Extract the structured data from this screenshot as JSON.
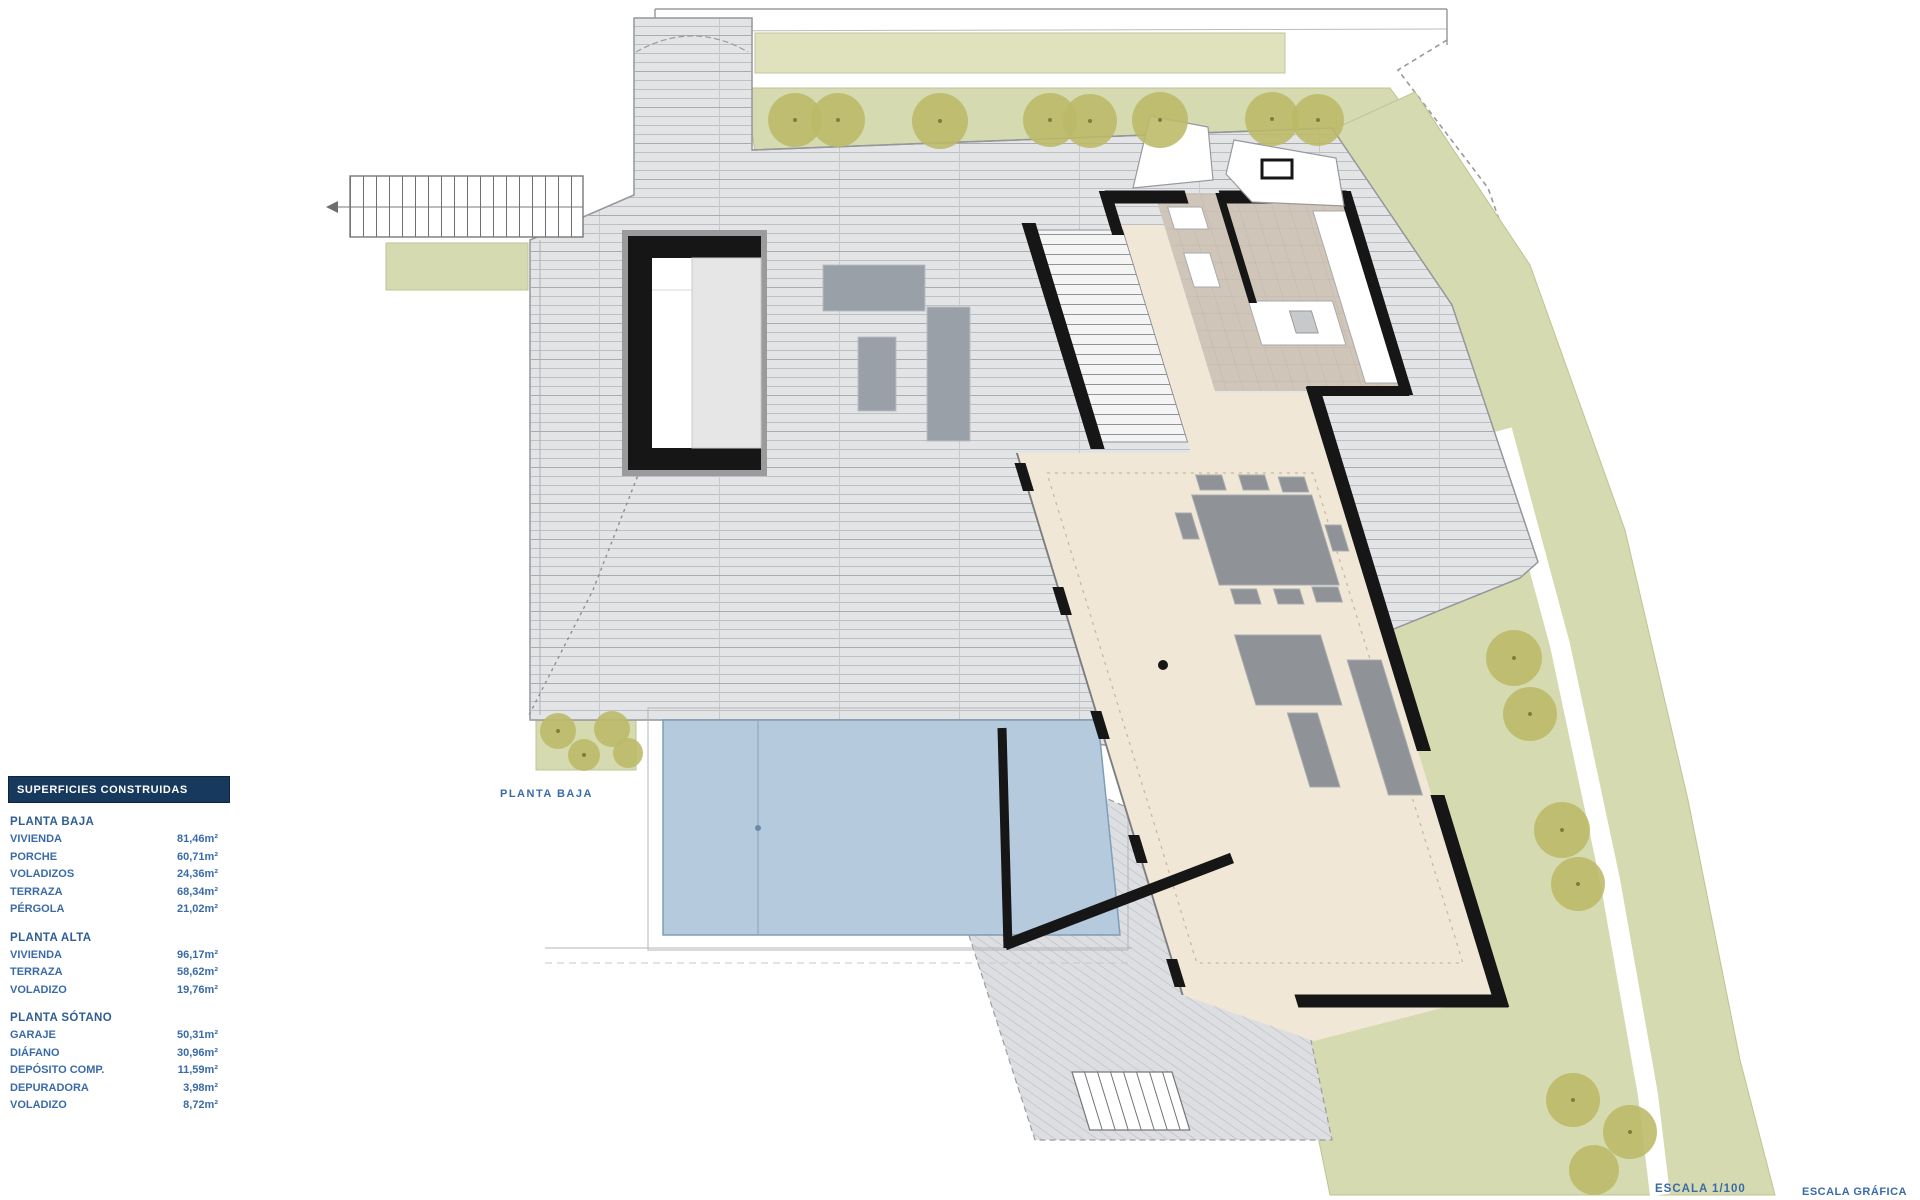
{
  "plan": {
    "floor_label": "PLANTA BAJA",
    "scale_label": "ESCALA  1/100",
    "graphic_scale_label": "ESCALA GRÁFICA"
  },
  "legend": {
    "header": "SUPERFICIES CONSTRUIDAS",
    "sections": [
      {
        "title": "PLANTA BAJA",
        "rows": [
          {
            "label": "VIVIENDA",
            "value": "81,46m²"
          },
          {
            "label": "PORCHE",
            "value": "60,71m²"
          },
          {
            "label": "VOLADIZOS",
            "value": "24,36m²"
          },
          {
            "label": "TERRAZA",
            "value": "68,34m²"
          },
          {
            "label": "PÉRGOLA",
            "value": "21,02m²"
          }
        ]
      },
      {
        "title": "PLANTA ALTA",
        "rows": [
          {
            "label": "VIVIENDA",
            "value": "96,17m²"
          },
          {
            "label": "TERRAZA",
            "value": "58,62m²"
          },
          {
            "label": "VOLADIZO",
            "value": "19,76m²"
          }
        ]
      },
      {
        "title": "PLANTA SÓTANO",
        "rows": [
          {
            "label": "GARAJE",
            "value": "50,31m²"
          },
          {
            "label": "DIÁFANO",
            "value": "30,96m²"
          },
          {
            "label": "DEPÓSITO COMP.",
            "value": "11,59m²"
          },
          {
            "label": "DEPURADORA",
            "value": "3,98m²"
          },
          {
            "label": "VOLADIZO",
            "value": "8,72m²"
          }
        ]
      }
    ]
  },
  "colors": {
    "legend_header_bg": "#17395d",
    "legend_text": "#2e5e94",
    "deck": "#e3e4e6",
    "garden": "#d6dab0",
    "tree": "#bcba67",
    "pool": "#b5cbdd",
    "interior_beige": "#f0e7d7",
    "interior_taupe": "#cfc5b8",
    "wall": "#161616"
  }
}
